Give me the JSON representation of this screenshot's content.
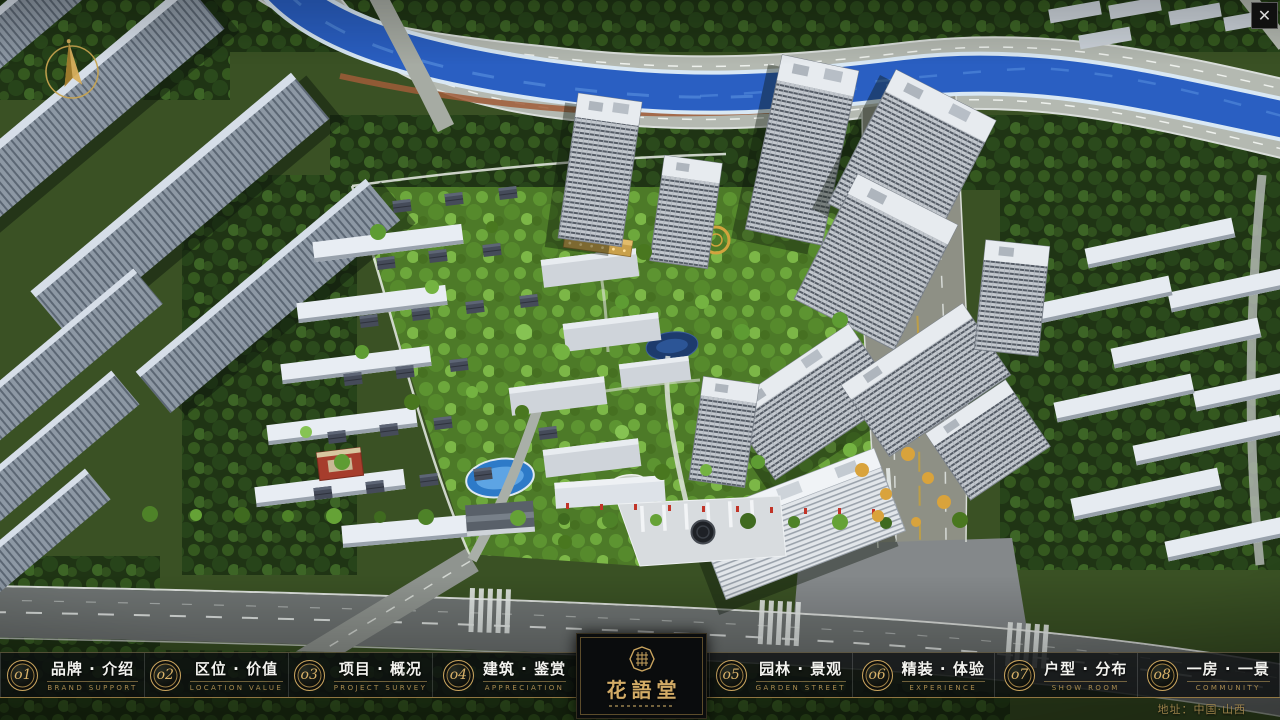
{
  "ui": {
    "close": {
      "glyph": "✕"
    },
    "logo": {
      "name": "花語堂"
    },
    "footer_address": "地址：中国·山西",
    "menu_items": [
      {
        "num": "o1",
        "zh": "品牌 · 介绍",
        "en": "BRAND SUPPORT"
      },
      {
        "num": "o2",
        "zh": "区位 · 价值",
        "en": "LOCATION VALUE"
      },
      {
        "num": "o3",
        "zh": "项目 · 概况",
        "en": "PROJECT SURVEY"
      },
      {
        "num": "o4",
        "zh": "建筑 · 鉴赏",
        "en": "APPRECIATION"
      },
      {
        "num": "o5",
        "zh": "园林 · 景观",
        "en": "GARDEN STREET"
      },
      {
        "num": "o6",
        "zh": "精装 · 体验",
        "en": "EXPERIENCE"
      },
      {
        "num": "o7",
        "zh": "户型 · 分布",
        "en": "SHOW ROOM"
      },
      {
        "num": "o8",
        "zh": "一房 · 一景",
        "en": "COMMUNITY"
      }
    ],
    "colors": {
      "accent_gold": "#c8a45c",
      "river_blue": "#2a5fc2",
      "park_green": "#4d7a28",
      "bar_background": "rgba(12,14,15,0.78)"
    }
  }
}
